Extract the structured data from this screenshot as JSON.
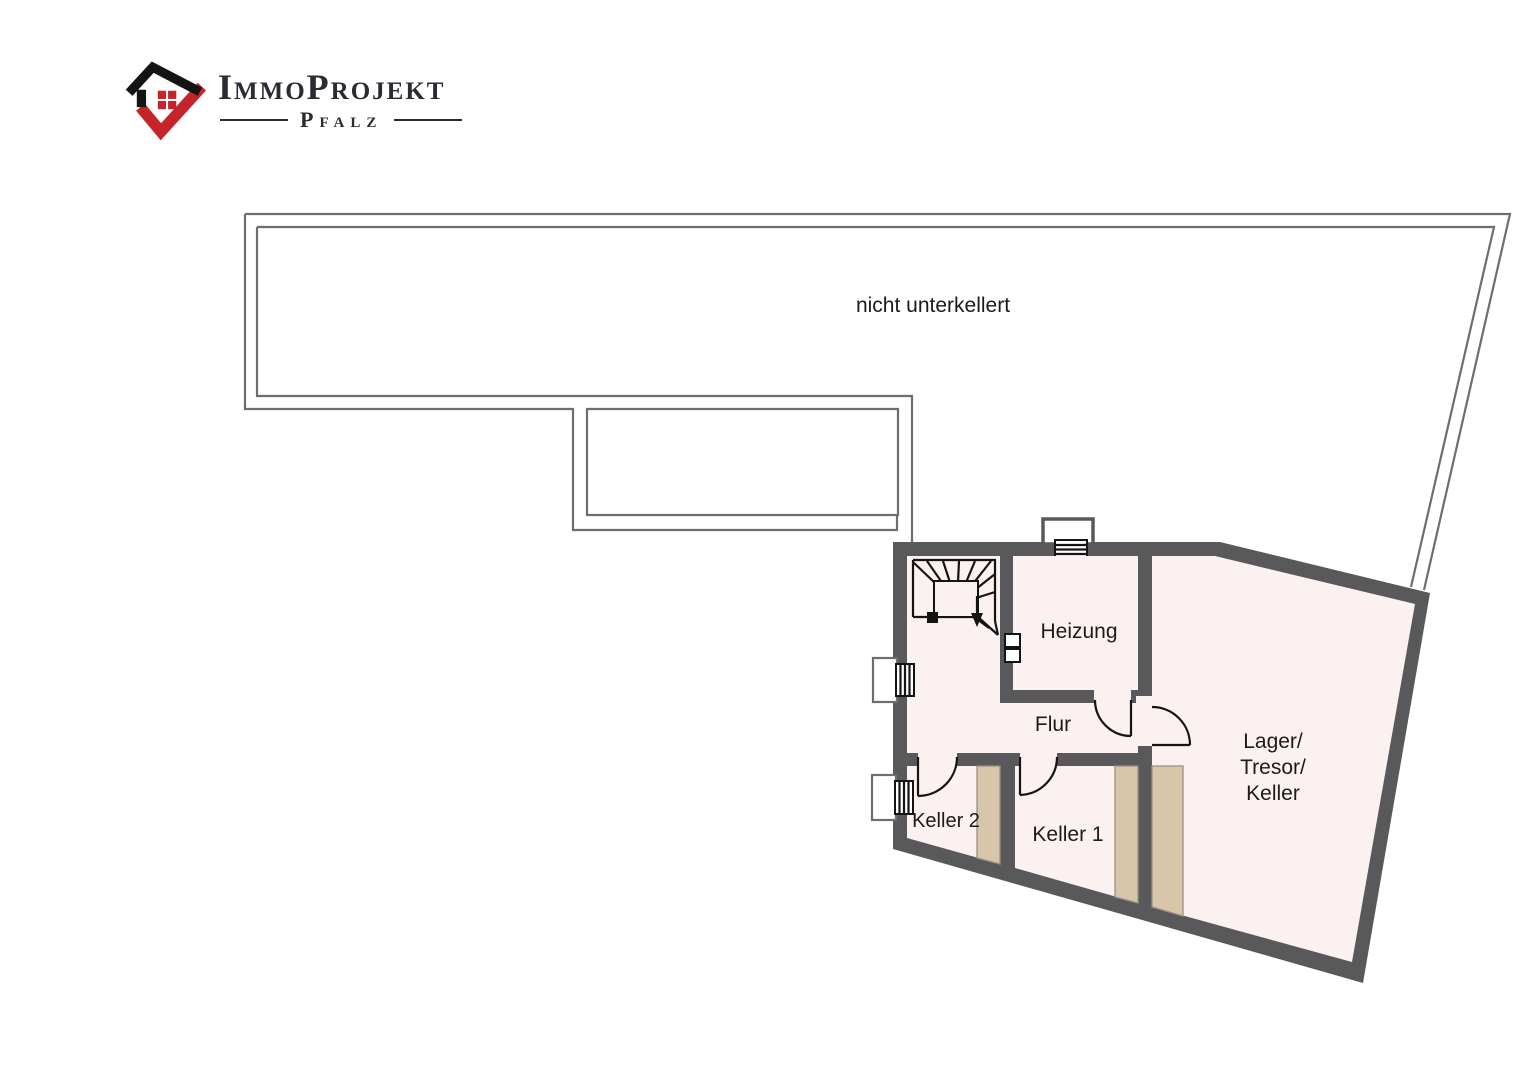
{
  "logo": {
    "brand": "ImmoProjekt",
    "region": "Pfalz",
    "colors": {
      "accent_red": "#c5242b",
      "text_dark": "#2b2b33"
    }
  },
  "plan": {
    "area_label": "nicht unterkellert",
    "rooms": {
      "heizung": {
        "label": "Heizung"
      },
      "flur": {
        "label": "Flur"
      },
      "keller1": {
        "label": "Keller 1"
      },
      "keller2": {
        "label": "Keller 2"
      },
      "lager": {
        "lines": [
          "Lager/",
          "Tresor/",
          "Keller"
        ]
      }
    },
    "colors": {
      "wall": "#59595b",
      "floor": "#faf1f0",
      "strip": "#d8c6ab",
      "outline": "#6e6e6e",
      "ink": "#141414",
      "label": "#1b1b1b"
    }
  }
}
